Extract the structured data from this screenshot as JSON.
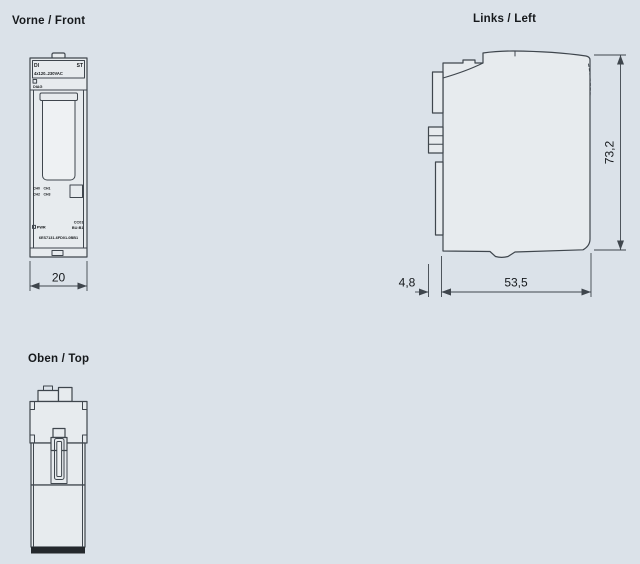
{
  "colors": {
    "background": "#dbe2e9",
    "line": "#3f464d",
    "fill_body": "#e7ebee",
    "fill_panel": "#eef1f3",
    "band": "#24282c",
    "text": "#16191c"
  },
  "views": {
    "front": {
      "title": "Vorne / Front",
      "dim_width": "20"
    },
    "left": {
      "title": "Links / Left",
      "dim_height": "73,2",
      "dim_depth": "53,5",
      "dim_rear": "4,8"
    },
    "top": {
      "title": "Oben / Top"
    }
  },
  "module_labels": {
    "type": "DI",
    "variant": "ST",
    "voltage": "4x120..230VAC",
    "diag": "DIAG",
    "ch0": "CH0",
    "ch1": "CH1",
    "ch2": "CH2",
    "ch3": "CH3",
    "pwr": "PWR",
    "color_code": "CC01",
    "base_unit": "BU:B1",
    "article_number": "6ES7131-6FD01-0BB1"
  }
}
